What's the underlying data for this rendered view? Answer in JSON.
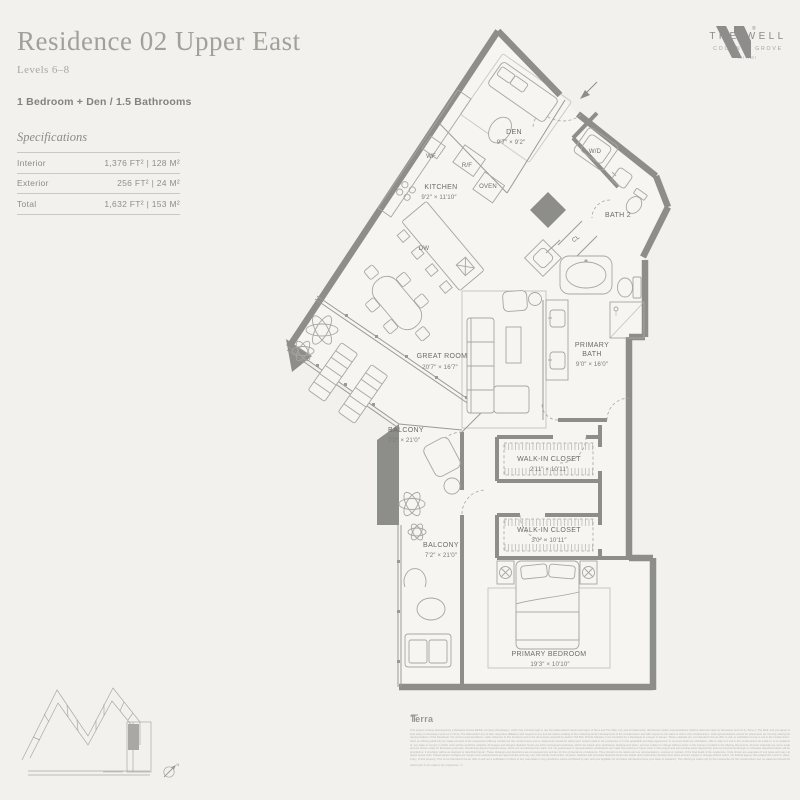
{
  "header": {
    "title": "Residence 02 Upper East",
    "levels": "Levels 6–8",
    "bedrooms": "1 Bedroom + Den / 1.5 Bathrooms"
  },
  "specs": {
    "title": "Specifications",
    "rows": [
      {
        "label": "Interior",
        "value": "1,376 FT²  |  128 M²"
      },
      {
        "label": "Exterior",
        "value": "256 FT²  |  24 M²"
      },
      {
        "label": "Total",
        "value": "1,632 FT²  |  153 M²"
      }
    ]
  },
  "logo": {
    "registered": "®",
    "name": "THE WELL",
    "sub": "COCONUT GROVE",
    "city": "MIAMI"
  },
  "floorplan": {
    "labels": [
      {
        "name": "den-label",
        "t": "DEN",
        "x": 514,
        "y": 134
      },
      {
        "name": "den-dims",
        "t": "9′7″ × 9′2″",
        "x": 511,
        "y": 144,
        "cls": "dim"
      },
      {
        "name": "wf-label",
        "t": "WF",
        "x": 431,
        "y": 158,
        "cls": "fix"
      },
      {
        "name": "rf-label",
        "t": "R/F",
        "x": 467,
        "y": 167,
        "cls": "fix"
      },
      {
        "name": "oven-label",
        "t": "OVEN",
        "x": 488,
        "y": 188,
        "cls": "fix"
      },
      {
        "name": "kitchen-label",
        "t": "KITCHEN",
        "x": 441,
        "y": 189
      },
      {
        "name": "kitchen-dims",
        "t": "9′2″ × 11′10″",
        "x": 439,
        "y": 199,
        "cls": "dim"
      },
      {
        "name": "wd-label",
        "t": "W/D",
        "x": 595,
        "y": 153,
        "cls": "fix"
      },
      {
        "name": "bath2-label",
        "t": "BATH 2",
        "x": 618,
        "y": 217
      },
      {
        "name": "cl-label",
        "t": "CL",
        "x": 577,
        "y": 240,
        "rot": -38,
        "cls": "fix"
      },
      {
        "name": "dw-label",
        "t": "DW",
        "x": 424,
        "y": 250,
        "cls": "fix"
      },
      {
        "name": "great-room-label",
        "t": "GREAT ROOM",
        "x": 442,
        "y": 358
      },
      {
        "name": "great-room-dims",
        "t": "20′7″ × 16′7″",
        "x": 440,
        "y": 369,
        "cls": "dim"
      },
      {
        "name": "primary-bath-label-1",
        "t": "PRIMARY",
        "x": 592,
        "y": 347
      },
      {
        "name": "primary-bath-label-2",
        "t": "BATH",
        "x": 592,
        "y": 356
      },
      {
        "name": "primary-bath-dims",
        "t": "9′0″ × 16′0″",
        "x": 592,
        "y": 366,
        "cls": "dim"
      },
      {
        "name": "balcony-upper-label",
        "t": "BALCONY",
        "x": 406,
        "y": 432
      },
      {
        "name": "balcony-upper-dims",
        "t": "7′2″ × 21′0″",
        "x": 404,
        "y": 442,
        "cls": "dim"
      },
      {
        "name": "wic1-label",
        "t": "WALK-IN CLOSET",
        "x": 549,
        "y": 461
      },
      {
        "name": "wic1-dims",
        "t": "2′11″ × 10′11″",
        "x": 549,
        "y": 471,
        "cls": "dim"
      },
      {
        "name": "wic2-label",
        "t": "WALK-IN CLOSET",
        "x": 549,
        "y": 532
      },
      {
        "name": "wic2-dims",
        "t": "3′0″ × 10′11″",
        "x": 549,
        "y": 542,
        "cls": "dim"
      },
      {
        "name": "balcony-lower-label",
        "t": "BALCONY",
        "x": 441,
        "y": 547
      },
      {
        "name": "balcony-lower-dims",
        "t": "7′2″ × 21′0″",
        "x": 441,
        "y": 557,
        "cls": "dim"
      },
      {
        "name": "primary-bedroom-label",
        "t": "PRIMARY BEDROOM",
        "x": 549,
        "y": 656
      },
      {
        "name": "primary-bedroom-dims",
        "t": "19′3″ × 10′10″",
        "x": 550,
        "y": 666,
        "cls": "dim"
      },
      {
        "name": "compass-north-label",
        "t": "N",
        "x": 178,
        "y": 766,
        "cls": "tiny"
      }
    ]
  },
  "footer": {
    "brand": "Terra",
    "equal_housing_icon": "⌂",
    "fine_print": "This project is being developed by a Delaware limited liability company (Developer), which has a limited right to use the trademarked names and logos of Terra and The Well. Any and all statements, disclosures and/or representations shall be deemed made by Developer and not by Terra or The Well, and you agree to look solely to Developer (and not to Terra, The Well and/or any of their respective affiliates) with respect to any and all matters relating to the marketing and/or development of the Condominium and with respect to the sales of units in the Condominium. Oral representations cannot be relied upon as correctly stating the representations of the Developer. For correct representations, make reference to this brochure and to the documents required by section 718.503, Florida Statutes, to be furnished by a Developer to a buyer or lessee. These materials are not intended to be an offer to sell, or solicitation to buy a unit in the condominium. Such an offering shall only be made pursuant to the prospectus (offering circular) for the condominium and no statements should be relied upon unless made in the prospectus or in the applicable purchase agreement. In no event shall any solicitation, offer or sale of a unit in the condominium be made in, or to residents of, any state or country in which such activity would be unlawful. All images and designs depicted herein are artist conceptual renderings, which are based upon preliminary development plans, and are subject to change without notice in the manner provided in the offering documents. All such materials are not to scale and are shown solely for illustrative purposes. Renderings depict proposed views, which are not identical from each unit. No guarantees or representations whatsoever are made that existing or future views of the project and surrounding areas depicted by artist conceptual renderings or otherwise described herein will be provided or, if provided, will be as depicted or described herein. These drawings and depictions are conceptual only and are for the convenience of reference. They should not be relied upon as representations, express or implied, of the final detail of the residences. Units shown are examples of unit types and may not depict actual units. Stated square footages are ranges and measurements are approximate and may vary with actual construction. All plans, features and amenities depicted herein are based upon preliminary development plans and are subject to change without notice. No federal agency has judged the merits or value, if any, of this property. This is not intended to be an offer to sell nor a solicitation of offers to buy real estate in any jurisdiction where prohibited by law, and your eligibility for purchase will depend upon your state of residency. This offering is made only by the prospectus for the condominium and no statement should be relied upon if not made in the prospectus."
  }
}
